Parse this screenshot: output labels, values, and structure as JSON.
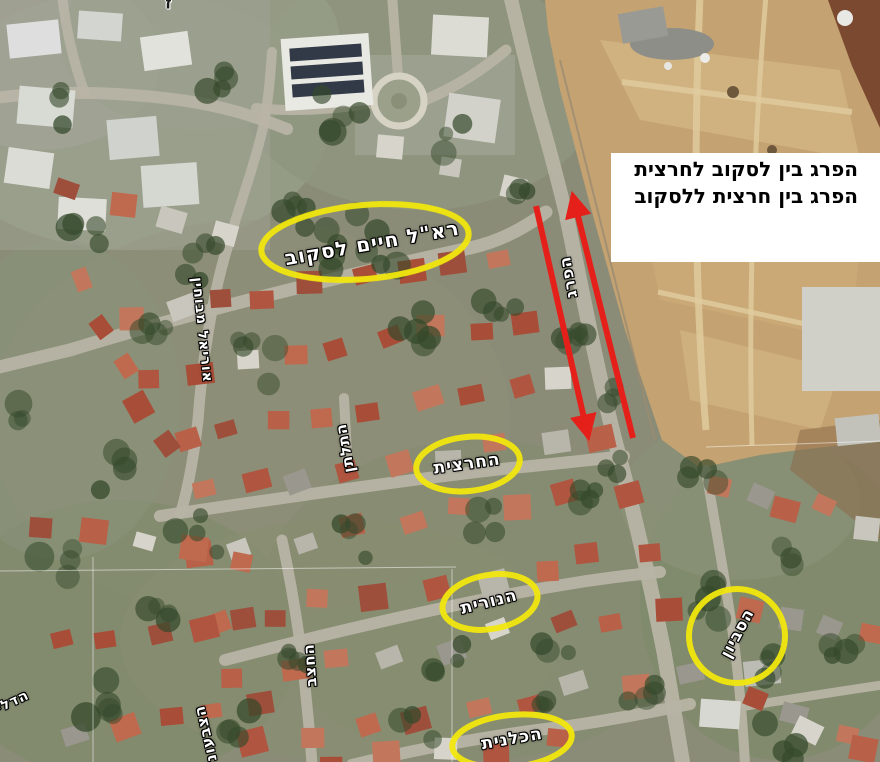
{
  "map": {
    "kind": "aerial-photo-of-residential-neighborhood-with-construction-site",
    "highlighted_streets_count": 5
  },
  "annotation_box": {
    "line1": "הפרג בין לסקוב לחרצית",
    "line2": "הפרג בין חרצית ללסקוב"
  },
  "street_labels": {
    "laskov": "רא\"ל חיים לסקוב",
    "parag": "הפרג",
    "hartzit": "החרצית",
    "nurit": "הנורית",
    "savyon": "הסביון",
    "kalanit": "הכלנית",
    "tiltan": "התלתן",
    "hatzav": "החצב",
    "uriel": "אוריאל מבוחין",
    "tzivoni": "הצבעוני",
    "dalia": "הדליה",
    "top_fragment": "ז"
  },
  "colors": {
    "highlight_yellow": "#f2e70e",
    "arrow_red": "#e5201a",
    "label_text": "#ffffff",
    "label_outline": "#000000",
    "info_box_bg": "#ffffff",
    "info_box_text": "#000000",
    "dirt_area": "#c4a271",
    "roof_terracotta": "#b05540",
    "road_gray": "#b8b4a5"
  }
}
